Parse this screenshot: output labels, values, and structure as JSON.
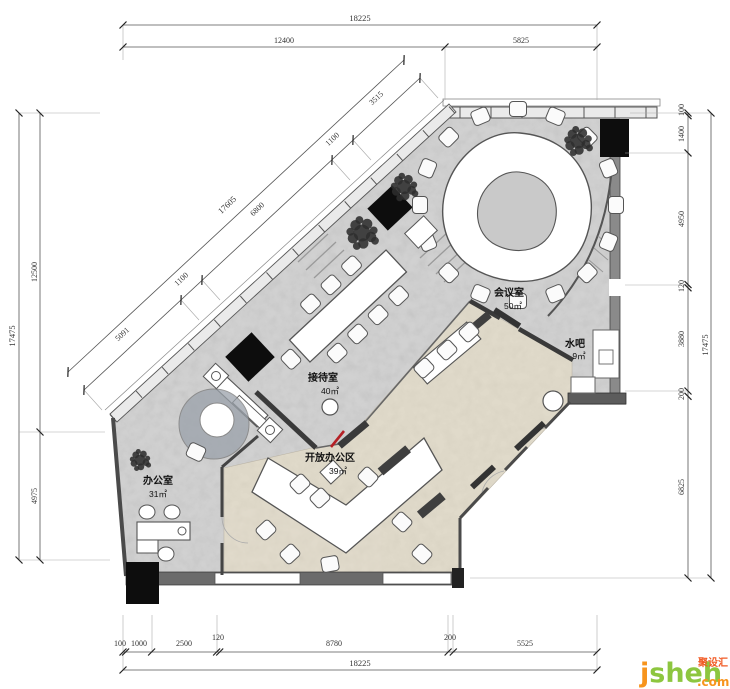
{
  "page": {
    "background": "#ffffff",
    "type_label": "office floor plan drawing"
  },
  "rooms": [
    {
      "name": "办公室",
      "area": "31㎡"
    },
    {
      "name": "接待室",
      "area": "40㎡"
    },
    {
      "name": "会议室",
      "area": "50㎡"
    },
    {
      "name": "开放办公区",
      "area": "39㎡"
    },
    {
      "name": "水吧",
      "area": "9㎡"
    }
  ],
  "dimensions": {
    "top": {
      "total": "18225",
      "segments": [
        "12400",
        "5825"
      ]
    },
    "bottom": {
      "total": "18225",
      "segments": [
        "100",
        "1000",
        "2500",
        "120",
        "8780",
        "200",
        "5525"
      ]
    },
    "left": {
      "total": "17475",
      "segments": [
        "12500",
        "4975"
      ]
    },
    "right": {
      "total": "17475",
      "segments": [
        "100",
        "1400",
        "4950",
        "120",
        "3880",
        "200",
        "6825"
      ]
    },
    "diagonal": {
      "total": "17605",
      "segments": [
        "5091",
        "1100",
        "6800",
        "1100",
        "3515"
      ]
    }
  },
  "watermark": {
    "brand_first": "j",
    "brand_rest": "sheh",
    "tld": ".com",
    "cn": "聚设汇"
  },
  "colors": {
    "floor_gray": "#c9c9c9",
    "floor_beige": "#ddd6c5",
    "wall_dark": "#3d3d3d",
    "accent_red": "#b52025",
    "logo_green": "#8dc63f",
    "logo_orange": "#f7941d"
  }
}
